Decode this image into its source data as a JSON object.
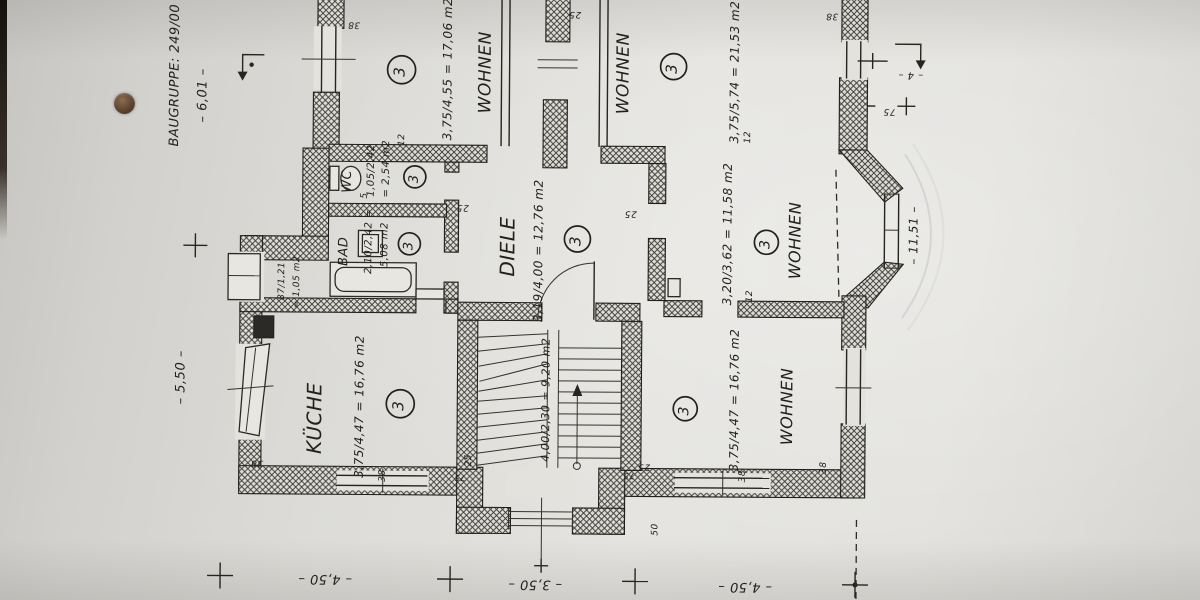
{
  "plan": {
    "edge": {
      "baugruppe": "BAUGRUPPE: 249/00",
      "dim_width_top": "– 6,01 –",
      "dim_height_left": "– 5,50 –",
      "dim_right": "– 11,51 –",
      "dim_bottom_left": "– 4,50 –",
      "dim_bottom_center": "– 3,50 –",
      "dim_bottom_right": "– 4,50 –",
      "tick_75_right": "75",
      "tick_75_bump_left": "75",
      "tick_75_bump_right": "75",
      "tick_50": "50",
      "mark_4": "– 4 –"
    },
    "rooms": [
      {
        "name": "WOHNEN",
        "area": "3,75/4,55 = 17,06 m2",
        "badge": "3"
      },
      {
        "name": "WOHNEN",
        "area": "3,75/5,74 = 21,53 m2",
        "badge": "3"
      },
      {
        "name": "WC",
        "area": "1,05/2,42",
        "area2": "= 2,54 m2",
        "badge": "3"
      },
      {
        "name": "BAD",
        "area": "2,10/2,42 =",
        "area2": "5,08 m2",
        "badge": "3"
      },
      {
        "area": "87/1,21",
        "area2": "= 1,05 m2"
      },
      {
        "name": "DIELE",
        "area": "3,19/4,00 = 12,76 m2",
        "badge": "3"
      },
      {
        "name": "WOHNEN",
        "area": "3,20/3,62 = 11,58 m2",
        "badge": "3"
      },
      {
        "name": "KÜCHE",
        "area": "3,75/4,47 = 16,76 m2",
        "badge": "3"
      },
      {
        "area": "4,00/2,30 = 9,20 m2"
      },
      {
        "name": "WOHNEN",
        "area": "3,75/4,47 = 16,76 m2",
        "badge": "3"
      }
    ],
    "wall_numbers": [
      "38",
      "38",
      "25",
      "12",
      "12",
      "5",
      "25",
      "25",
      "12",
      "38",
      "25",
      "38",
      "38",
      "38",
      "25"
    ]
  }
}
